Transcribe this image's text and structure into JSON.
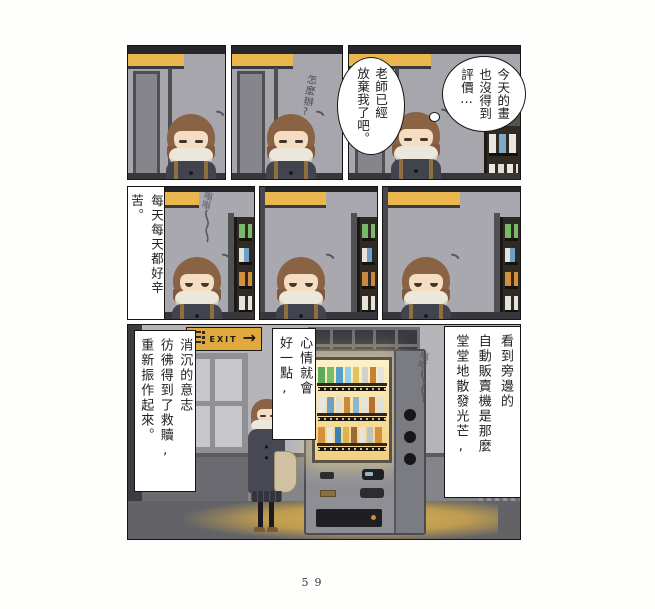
{
  "page_number": "59",
  "bubbles": {
    "today": "今天的畫\n也沒得到\n評價⋯",
    "teacher": "老師已經\n放棄我了吧。"
  },
  "handwriting": {
    "worry": "怎麼辦?"
  },
  "sfx": {
    "hum_row2": "嗡嗡",
    "hum_bottom": "嗡嗡"
  },
  "captions": {
    "everyday": "每天每天都好辛苦。",
    "will": "消沉的意志\n彷彿得到了救贖,\n重新振作起來。",
    "mood": "心情就會\n好一點,",
    "seeing": "看到旁邊的\n自動販賣機是那麼\n堂堂地散發光芒,"
  },
  "exit_sign": {
    "label": "EXIT",
    "arrow": "→"
  },
  "colors": {
    "sign_yellow": "#eab64e",
    "machine_glow": "#f6d98e",
    "floor_glow": "#cfa94e"
  }
}
